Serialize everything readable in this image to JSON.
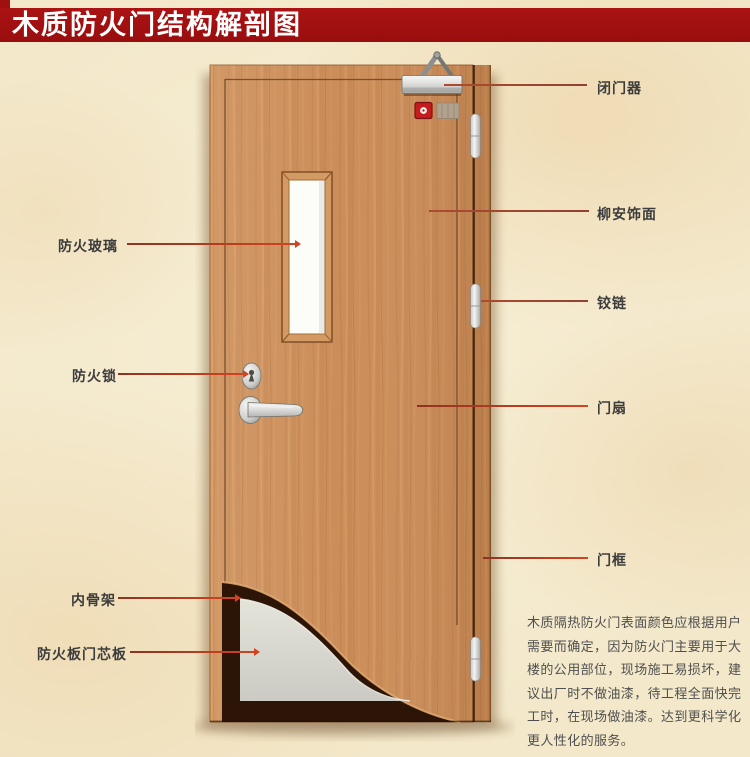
{
  "title": "木质防火门结构解剖图",
  "colors": {
    "banner_red": "#a20f10",
    "leader_bright_red": "#d4431f",
    "leader_maroon": "#a04534",
    "wood": "#cb8d59",
    "wood_dark": "#b47542",
    "skeleton_brown": "#2c1506",
    "core_gray": "#d8d7cf",
    "glass_white": "#fcfcf9",
    "background_paper": "#f3e8ca",
    "label_text": "#3c3c3c"
  },
  "labels": {
    "left": [
      {
        "id": "fire-glass",
        "text": "防火玻璃"
      },
      {
        "id": "fire-lock",
        "text": "防火锁"
      },
      {
        "id": "inner-skeleton",
        "text": "内骨架"
      },
      {
        "id": "fire-board-core",
        "text": "防火板门芯板"
      }
    ],
    "right": [
      {
        "id": "door-closer",
        "text": "闭门器"
      },
      {
        "id": "lauan-veneer",
        "text": "柳安饰面"
      },
      {
        "id": "hinge",
        "text": "铰链"
      },
      {
        "id": "door-leaf",
        "text": "门扇"
      },
      {
        "id": "door-frame",
        "text": "门框"
      }
    ]
  },
  "description": {
    "lines": [
      "木质隔热防火门表面颜色应根据用户",
      "需要而确定，因为防火门主要用于大",
      "楼的公用部位，现场施工易损坏，建",
      "议出厂时不做油漆，待工程全面快完",
      "工时，在现场做油漆。达到更科学化",
      "更人性化的服务。"
    ]
  }
}
